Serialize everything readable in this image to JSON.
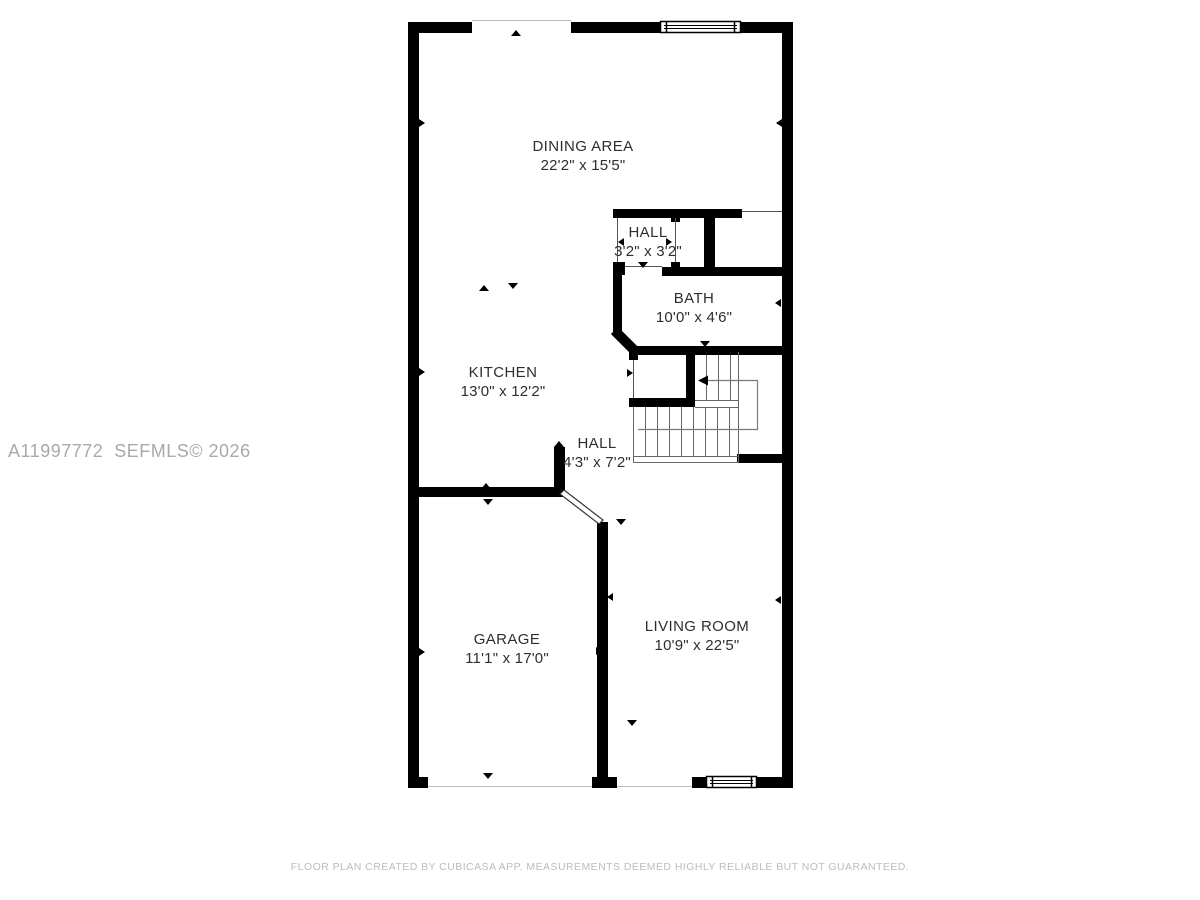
{
  "watermark": {
    "text": "A11997772  SEFMLS© 2026"
  },
  "footer": {
    "disclaimer": "FLOOR PLAN CREATED BY CUBICASA APP. MEASUREMENTS DEEMED HIGHLY RELIABLE BUT NOT GUARANTEED."
  },
  "floor_plan": {
    "rooms": [
      {
        "id": "dining-area",
        "name": "DINING AREA",
        "dimensions": "22'2\" x 15'5\""
      },
      {
        "id": "hall-upper",
        "name": "HALL",
        "dimensions": "3'2\" x 3'2\""
      },
      {
        "id": "bath",
        "name": "BATH",
        "dimensions": "10'0\" x 4'6\""
      },
      {
        "id": "kitchen",
        "name": "KITCHEN",
        "dimensions": "13'0\" x 12'2\""
      },
      {
        "id": "hall-lower",
        "name": "HALL",
        "dimensions": "4'3\" x 7'2\""
      },
      {
        "id": "garage",
        "name": "GARAGE",
        "dimensions": "11'1\" x 17'0\""
      },
      {
        "id": "living-room",
        "name": "LIVING ROOM",
        "dimensions": "10'9\" x 22'5\""
      }
    ],
    "colors": {
      "wall": "#000000",
      "thin_line": "#555555",
      "walk_line": "#7a7a7a",
      "opening_line": "#cccccc",
      "label_text": "#2e2e2e",
      "watermark_text": "#a9a9a9",
      "footer_text": "#bcbcbc"
    }
  }
}
